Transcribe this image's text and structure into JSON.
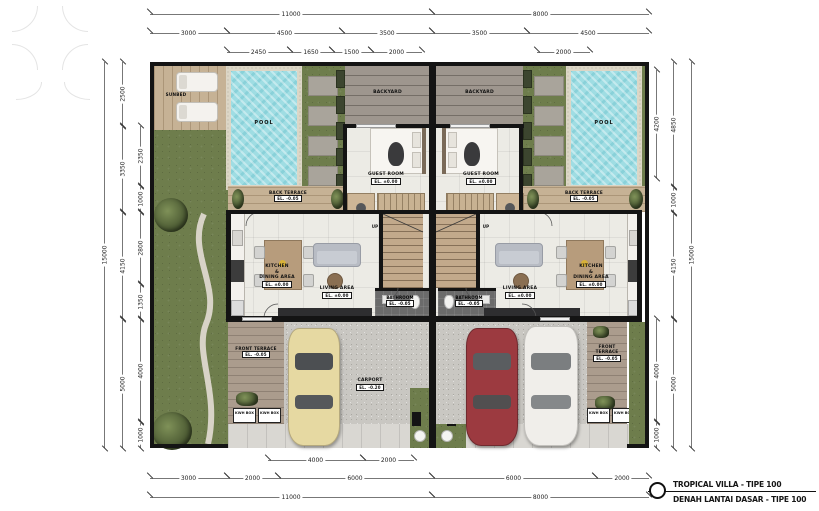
{
  "title_block": {
    "line1": "TROPICAL VILLA - TIPE 100",
    "line2": "DENAH LANTAI DASAR - TIPE 100"
  },
  "labels": {
    "pool": "POOL",
    "sunbed": "SUNBED",
    "backyard": "BACKYARD",
    "guest_room": "GUEST ROOM",
    "back_terrace": "BACK TERRACE",
    "front_terrace": "FRONT TERRACE",
    "living_area": "LIVING AREA",
    "kitchen_line1": "KITCHEN",
    "kitchen_line2": "&",
    "kitchen_line3": "DINING AREA",
    "bathroom": "BATHROOM",
    "carport": "CARPORT",
    "up": "UP",
    "kwh_box": "KWH BOX",
    "el_zero": "EL. ±0.00",
    "el_minus5": "EL. -0.05",
    "el_minus20": "EL. -0.20"
  },
  "dims": {
    "top1": [
      "11000",
      "8000"
    ],
    "top2": [
      "3000",
      "4500",
      "3500",
      "3500",
      "4500"
    ],
    "top3": [
      "2450",
      "1650",
      "1500",
      "2000",
      "2000"
    ],
    "bottom1": [
      "4000",
      "2000"
    ],
    "bottom2": [
      "3000",
      "2000",
      "6000",
      "6000",
      "2000"
    ],
    "bottom3": [
      "11000",
      "8000"
    ],
    "left_outer": [
      "15000"
    ],
    "left_mid": [
      "2500",
      "3350",
      "4150",
      "5000"
    ],
    "left_in": [
      "2350",
      "1000",
      "2800",
      "1350",
      "4000",
      "1000"
    ],
    "right_in": [
      "4200",
      "4000",
      "1000"
    ],
    "right_mid": [
      "4850",
      "1000",
      "4150",
      "5000"
    ],
    "right_outer": [
      "15000"
    ]
  },
  "colors": {
    "grass": "#6e7d4c",
    "pool_water": "#9fdde3",
    "deck_wood": "#c6b295",
    "paving": "#9e968e",
    "wall": "#141414",
    "carport_gravel": "#c9c7c2",
    "car_cream": "#e6d9a2",
    "car_red": "#9c3a40",
    "car_white": "#f0eeea"
  }
}
